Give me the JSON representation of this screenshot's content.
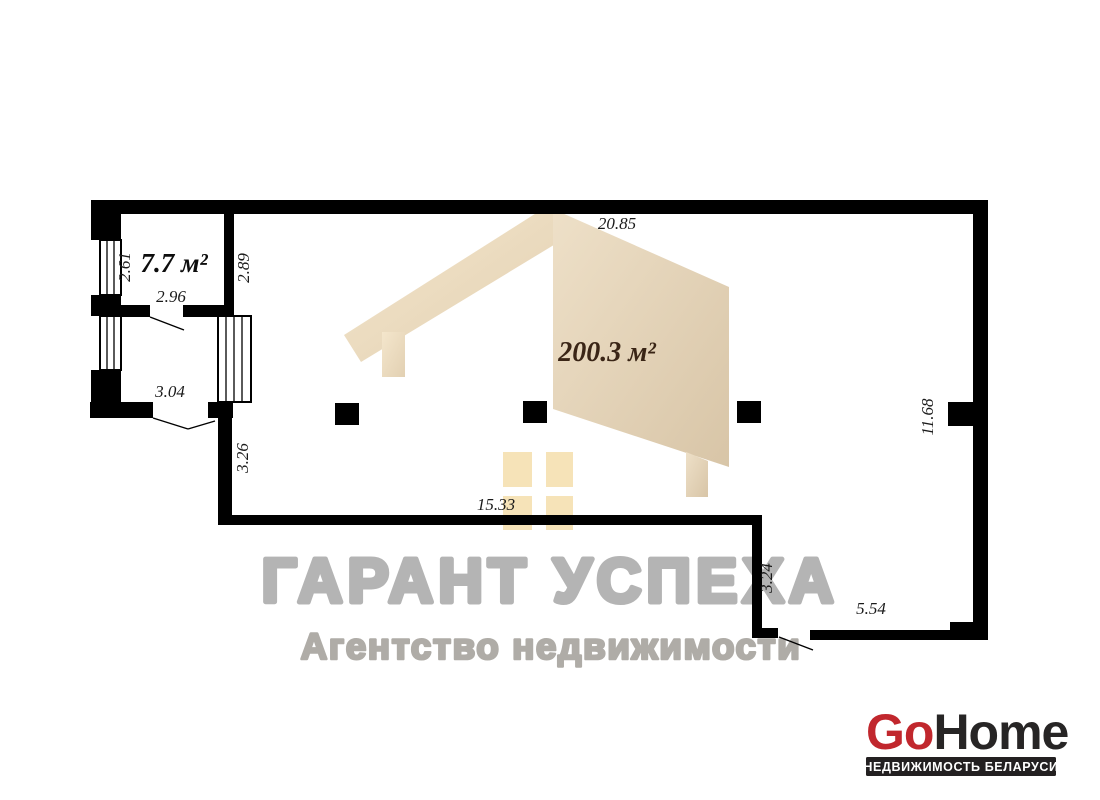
{
  "plan": {
    "rooms": [
      {
        "label": "7.7 м²"
      },
      {
        "label": "200.3 м²"
      }
    ],
    "dimensions": {
      "top_width": "20.85",
      "small_room_left": "2.61",
      "small_room_right": "2.89",
      "small_room_door": "2.96",
      "hall_door": "3.04",
      "lower_left_wall": "3.26",
      "bottom_width": "15.33",
      "right_height": "11.68",
      "step_vertical": "3.24",
      "step_bottom": "5.54"
    },
    "colors": {
      "wall": "#000000",
      "dimension_text": "#1a1a1a",
      "big_room_label": "#3a2516"
    }
  },
  "watermark": {
    "title": "ГАРАНТ УСПЕХА",
    "subtitle": "Агентство недвижимости",
    "colors": {
      "title": "#b4b4b4",
      "subtitle": "#afaca7",
      "house_light": "#eee0c8",
      "house_dark": "#dac8ab",
      "house_windows": "#f6e3b8"
    }
  },
  "logo": {
    "go": "Go",
    "home": "Home",
    "tagline": "НЕДВИЖИМОСТЬ БЕЛАРУСИ",
    "colors": {
      "go": "#c1272d",
      "home": "#272525",
      "bar": "#232021",
      "tagline_text": "#ffffff"
    }
  }
}
